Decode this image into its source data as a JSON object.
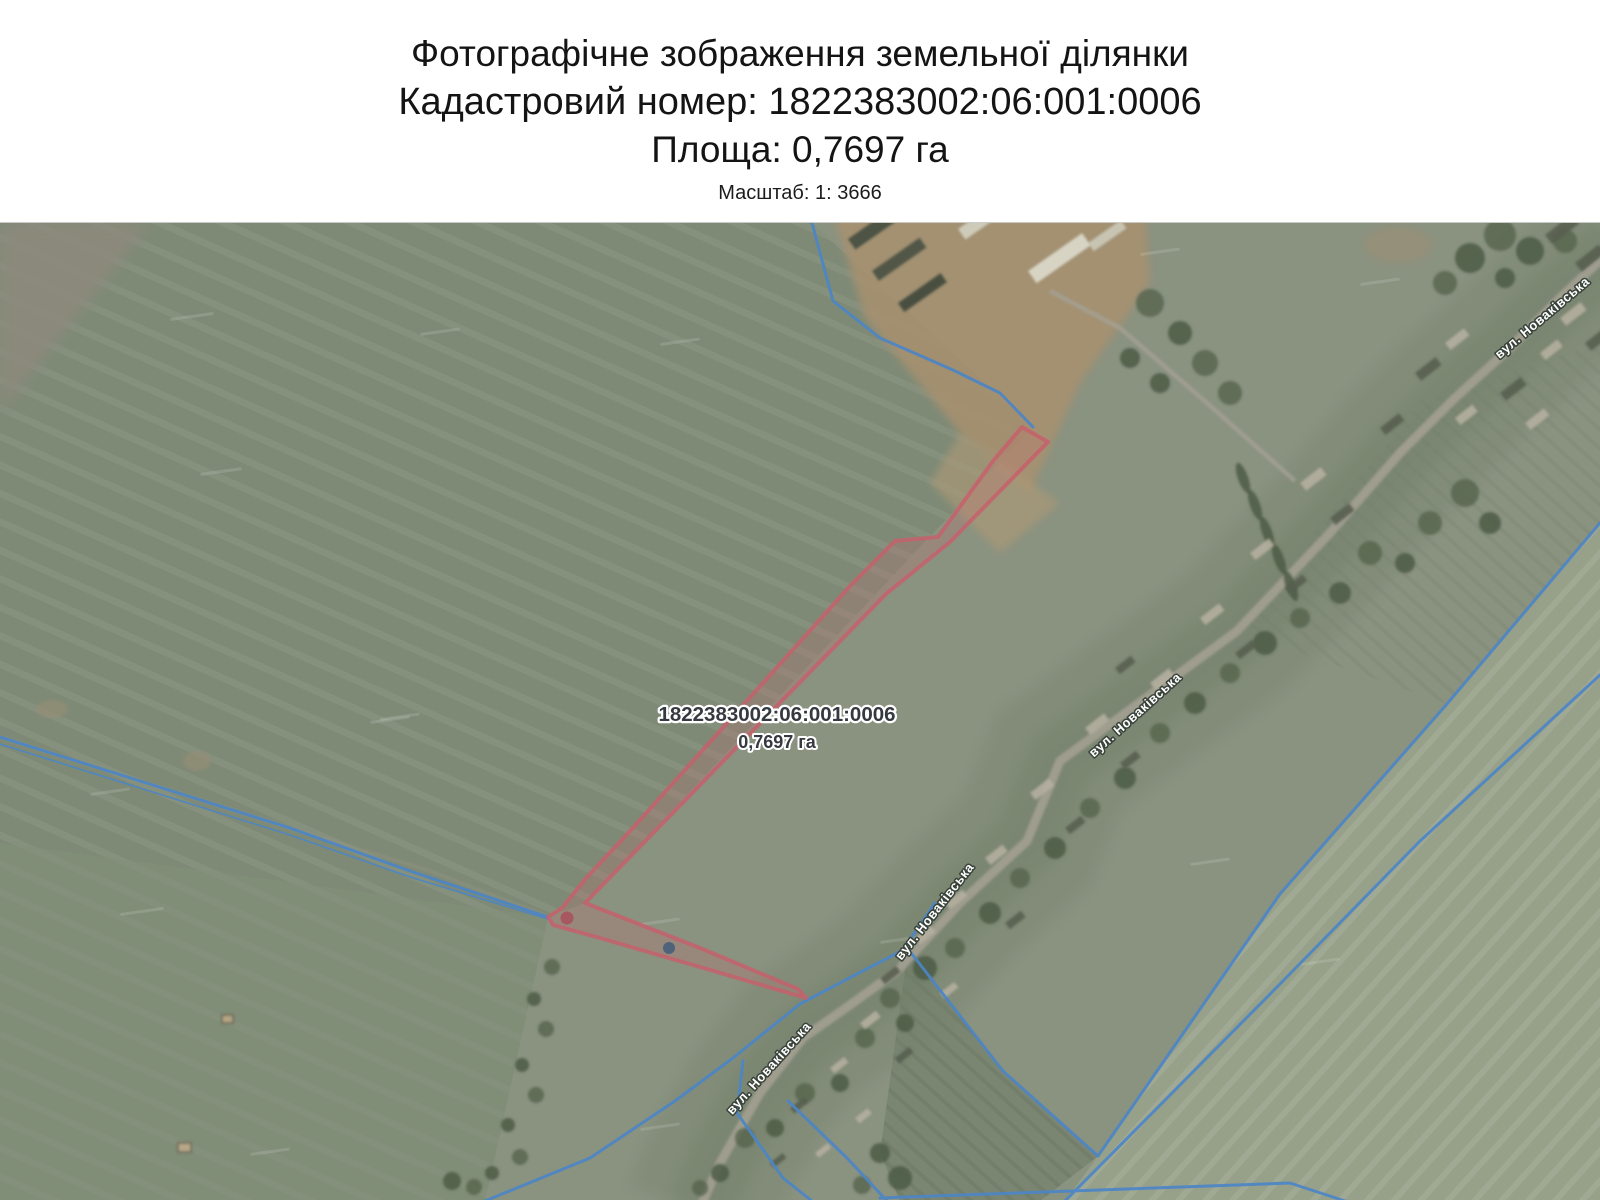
{
  "header": {
    "title": "Фотографічне зображення земельної ділянки",
    "cadastral_line": "Кадастровий номер: 1822383002:06:001:0006",
    "area_line": "Площа: 0,7697 га",
    "scale_line": "Масштаб: 1: 3666"
  },
  "map": {
    "parcel_label": {
      "number": "1822383002:06:001:0006",
      "area": "0,7697 га"
    },
    "street_label": "вул. Новаківська",
    "colors": {
      "boundary_blue": "#4c86c6",
      "parcel_stroke": "rgba(199,95,107,0.82)",
      "parcel_fill": "rgba(210,100,110,0.20)",
      "street_label_fill": "#ffffff",
      "street_label_halo": "#39433a",
      "parcel_label_fill": "#343a3f",
      "parcel_label_halo": "#ffffff",
      "vertex_marker_red": "#a84e59",
      "vertex_marker_blue": "#3c5a78"
    }
  }
}
